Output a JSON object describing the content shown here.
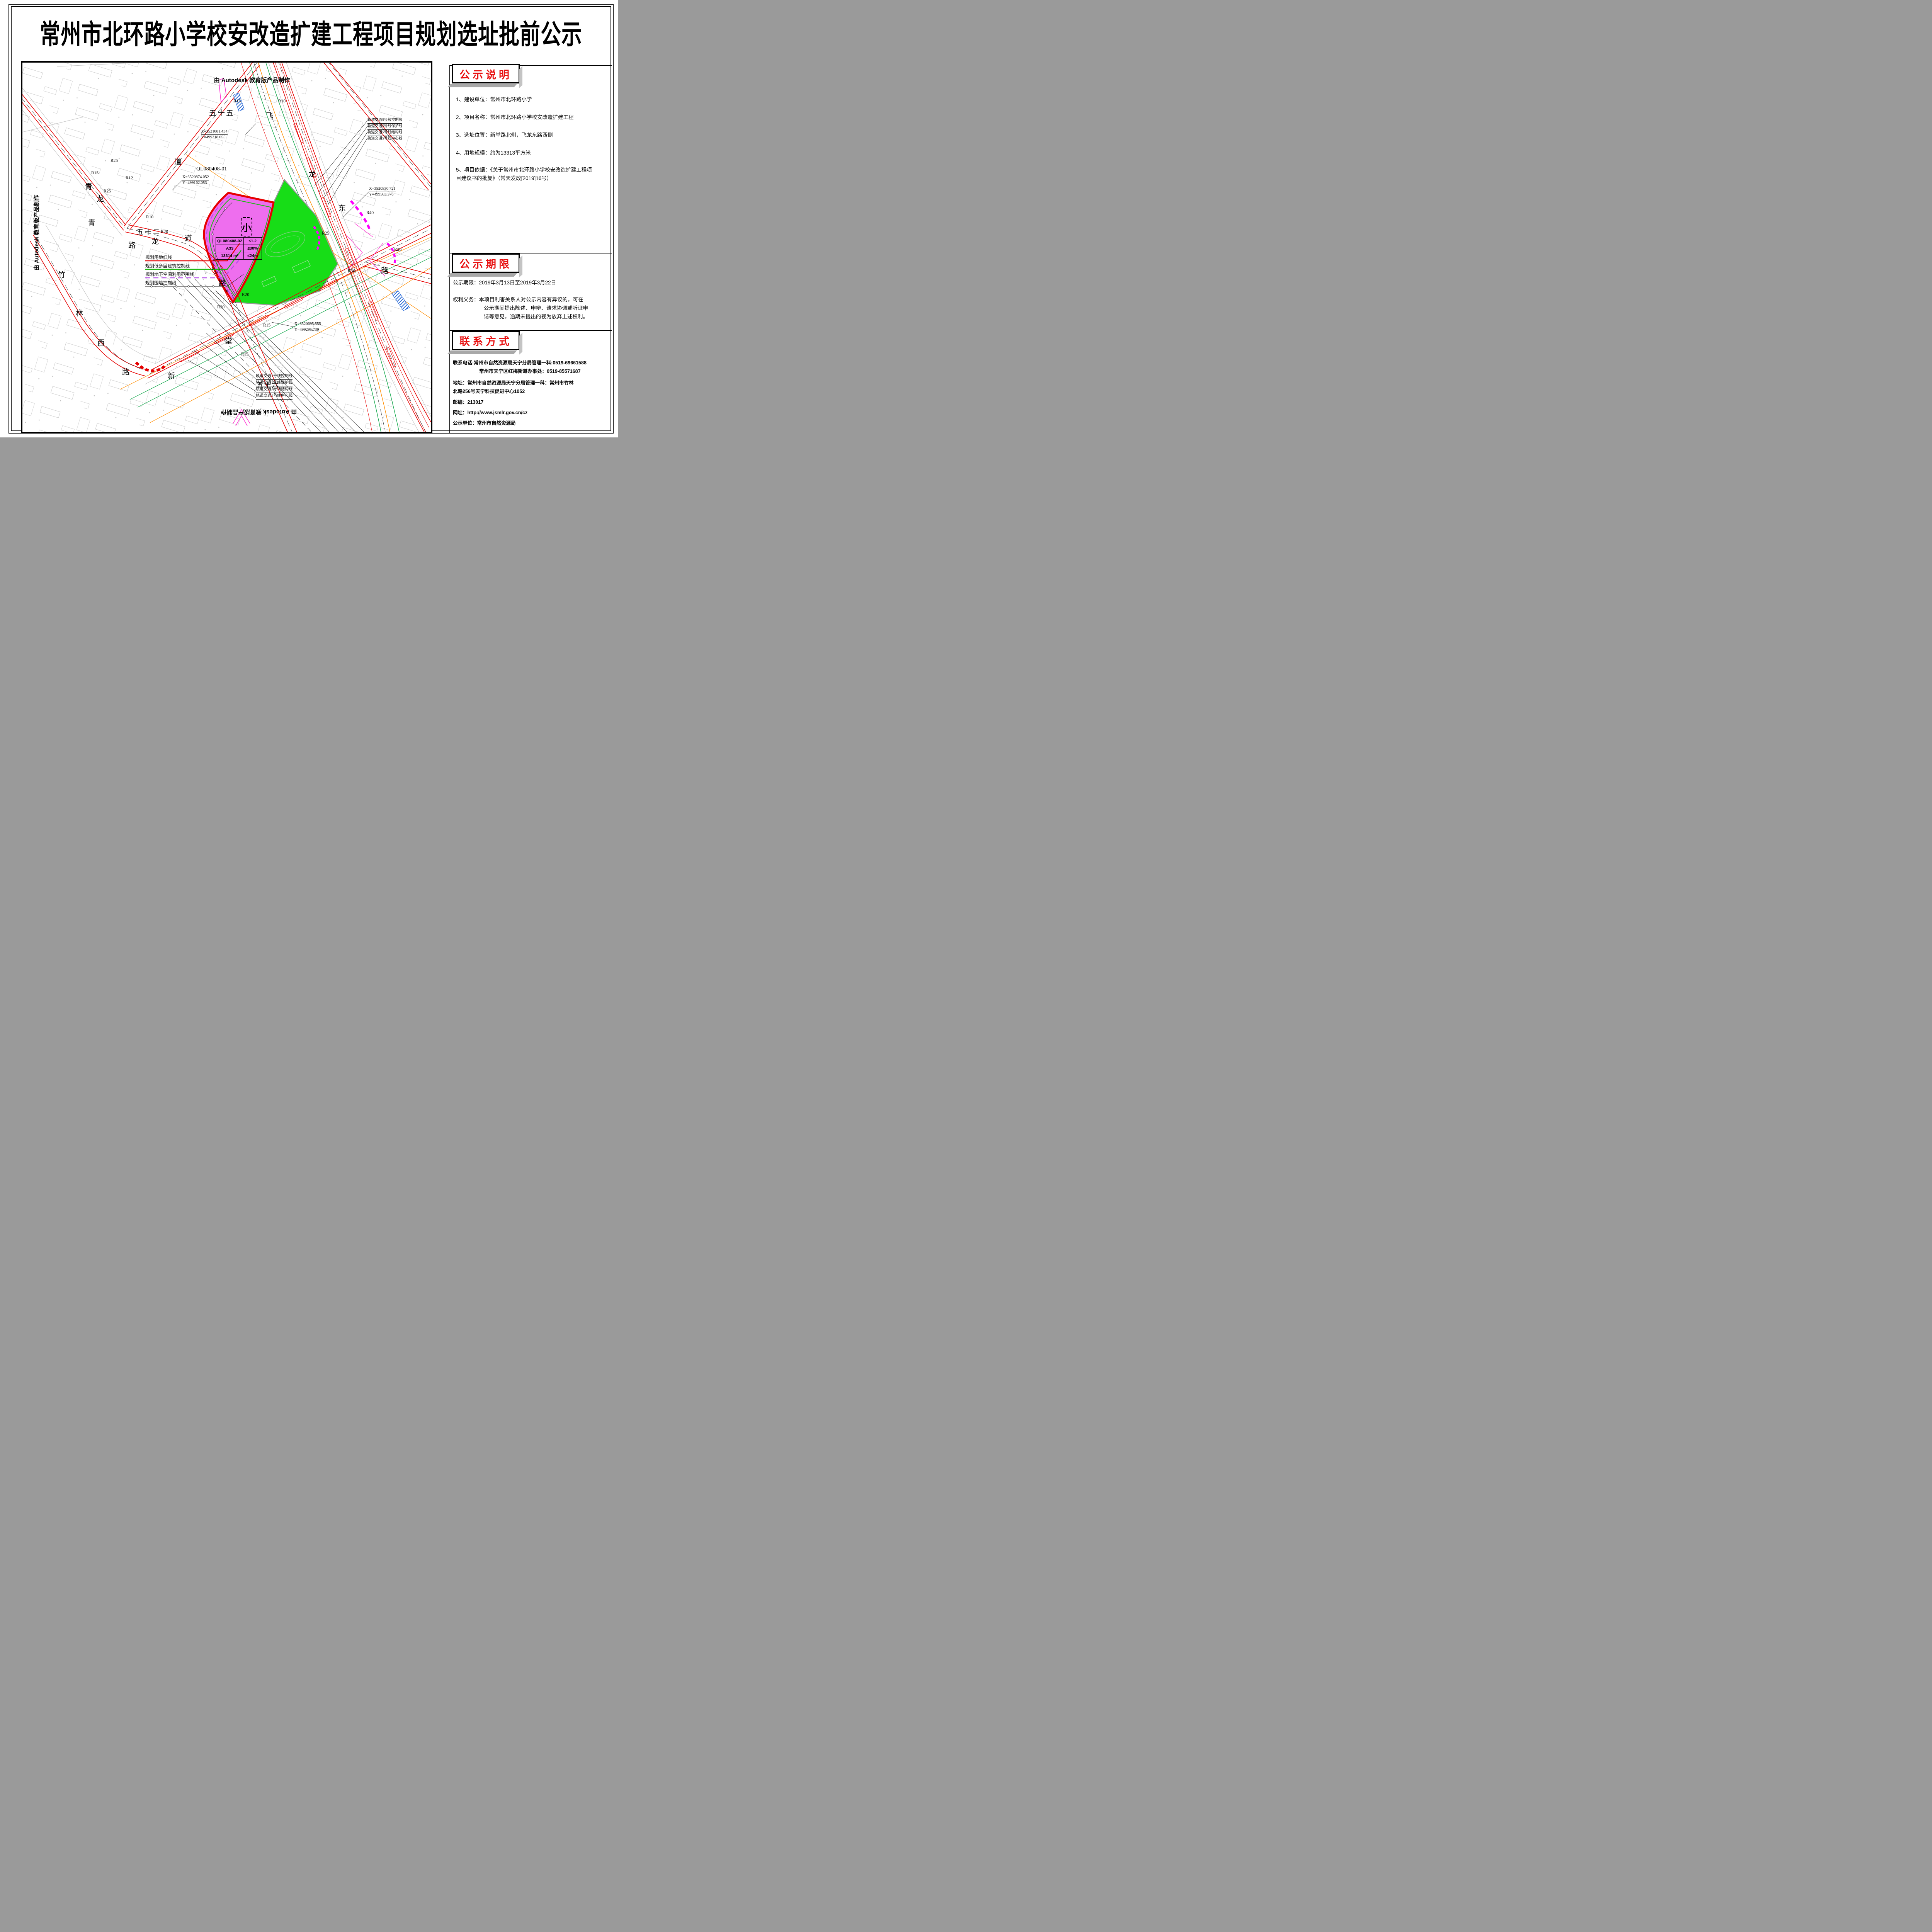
{
  "title": "常州市北环路小学校安改造扩建工程项目规划选址批前公示",
  "sidebar": {
    "sections": [
      {
        "header": "公示说明",
        "items": [
          "1、建设单位：常州市北环路小学",
          "2、项目名称：常州市北环路小学校安改造扩建工程",
          "3、选址位置：新堂路北侧，飞龙东路西侧",
          "4、用地规模：约为13313平方米",
          "5、项目依据：《关于常州市北环路小学校安改造扩建工程项",
          "目建议书的批复》（常天发改[2019]16号）"
        ]
      },
      {
        "header": "公示期限",
        "period_label": "公示期限：2019年3月13日至2019年3月22日",
        "rights_lines": [
          "权利义务：本项目利害关系人对公示内容有异议的，可在",
          "公示期间提出陈述、申辩、请求协调或听证申",
          "请等意见，逾期未提出的视为放弃上述权利。"
        ]
      },
      {
        "header": "联系方式",
        "contact_lines": [
          "联系电话:常州市自然资源局天宁分局管理一科:0519-69661588",
          "常州市天宁区红梅街道办事处：0519-85571687",
          "地址：常州市自然资源局天宁分局管理一科：常州市竹林",
          "北路256号天宁科技促进中心1052",
          "邮编：213017",
          "网址：http://www.jsmlr.gov.cn/cz",
          "公示单位：常州市自然资源局"
        ]
      }
    ]
  },
  "map": {
    "watermark_top": "由 Autodesk 教育版产品制作",
    "watermark_left": "由 Autodesk 教育版产品制作",
    "watermark_bottom": "由 Autodesk 教育版产品制作",
    "parcel_label": "QL080408-01",
    "plot_symbol": "小",
    "plot_table": {
      "rows": [
        [
          "QL080408-02",
          "≤1.2"
        ],
        [
          "A33",
          "≤30%"
        ],
        [
          "13314 m²",
          "≤24m"
        ]
      ]
    },
    "legend": [
      {
        "label": "规划用地红线",
        "style": "red-solid"
      },
      {
        "label": "规划低多层建筑控制线",
        "style": "green-solid"
      },
      {
        "label": "规划地下空间利用范围线",
        "style": "purple-dashed"
      },
      {
        "label": "规划围墙控制线",
        "style": "black-circles"
      }
    ],
    "coords": [
      {
        "x": "X=3521081.434",
        "y": "Y=499318.055"
      },
      {
        "x": "X=3520874.052",
        "y": "Y=499162.053"
      },
      {
        "x": "X=3520830.721",
        "y": "Y=499503.376"
      },
      {
        "x": "X=3520695.555",
        "y": "Y=499295.739"
      }
    ],
    "rail5_labels": [
      "轨道交通5号线控制线",
      "轨道交通5号线保护线",
      "轨道交通5号线结构线",
      "轨道交通5号线中心线"
    ],
    "rail1_labels": [
      "轨道交通1号线控制线",
      "轨道交通1号线保护线",
      "轨道交通1号线结构线",
      "轨道交通1号线中心线"
    ],
    "road_chars": [
      "五十五",
      "飞",
      "龙",
      "东",
      "路",
      "青",
      "龙",
      "道",
      "青",
      "路",
      "龙",
      "五十二",
      "道",
      "路",
      "竹",
      "林",
      "西",
      "路",
      "新",
      "堂",
      "五十六"
    ],
    "radius_labels": [
      "R15",
      "R10",
      "R15",
      "R25",
      "R12",
      "R25",
      "R10",
      "R20",
      "R20",
      "R20",
      "R40",
      "R25",
      "R20",
      "R50",
      "R15",
      "R15"
    ],
    "dims": [
      "8",
      "5",
      "3",
      "3",
      "14",
      "20",
      "30"
    ]
  },
  "colors": {
    "plot_fill": "#ee6eee",
    "school_fill": "#17dd17",
    "red_line": "#e60000",
    "green_line": "#12a84b",
    "orange_line": "#ff8c00",
    "purple_line": "#b54ce8",
    "magenta": "#ff00ff",
    "header_red": "#e81111"
  }
}
